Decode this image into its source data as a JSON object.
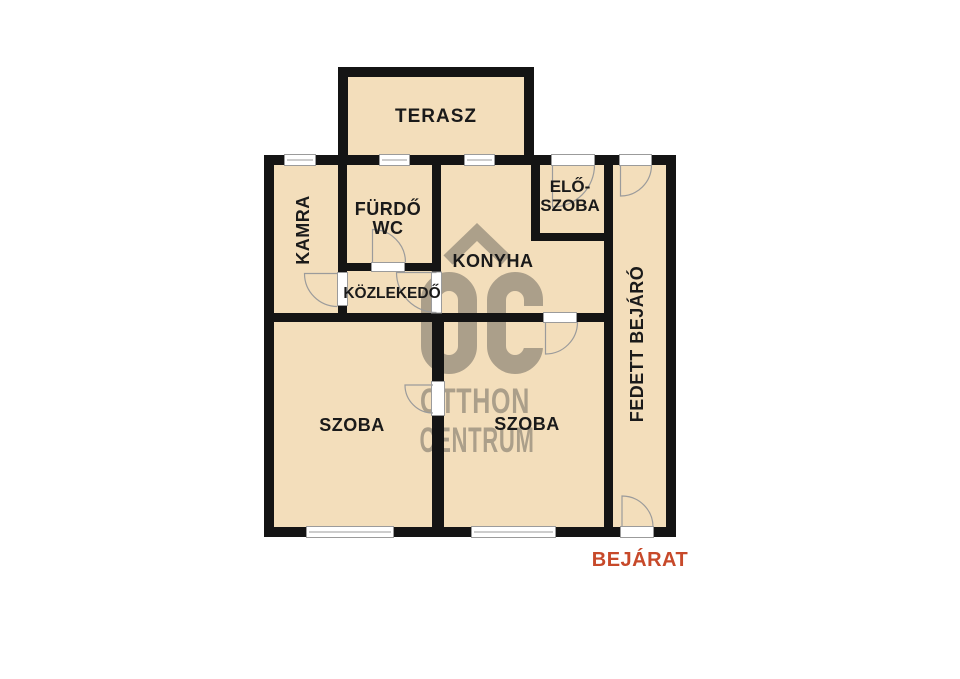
{
  "floorplan": {
    "colors": {
      "background": "#ffffff",
      "room_fill": "#f3debb",
      "wall": "#141414",
      "frame": "#9b9b9b",
      "label_text": "#1a1a1a",
      "entrance_text": "#c7492a",
      "watermark": "#5f5b56"
    },
    "rooms": [
      {
        "id": "terasz",
        "label": "TERASZ"
      },
      {
        "id": "kamra",
        "label": "KAMRA"
      },
      {
        "id": "furdo-wc",
        "label_line1": "FÜRDŐ",
        "label_line2": "WC"
      },
      {
        "id": "konyha",
        "label": "KONYHA"
      },
      {
        "id": "eloszoba",
        "label_line1": "ELŐ-",
        "label_line2": "SZOBA"
      },
      {
        "id": "kozlekedo",
        "label": "KÖZLEKEDŐ"
      },
      {
        "id": "szoba-bal",
        "label": "SZOBA"
      },
      {
        "id": "szoba-jobb",
        "label": "SZOBA"
      },
      {
        "id": "fedett-bejaro",
        "label": "FEDETT BEJÁRÓ"
      }
    ],
    "entrance_label": "BEJÁRAT",
    "watermark": {
      "logo": "oc-house-logo",
      "line1": "OTTHON",
      "line2": "CENTRUM"
    }
  }
}
